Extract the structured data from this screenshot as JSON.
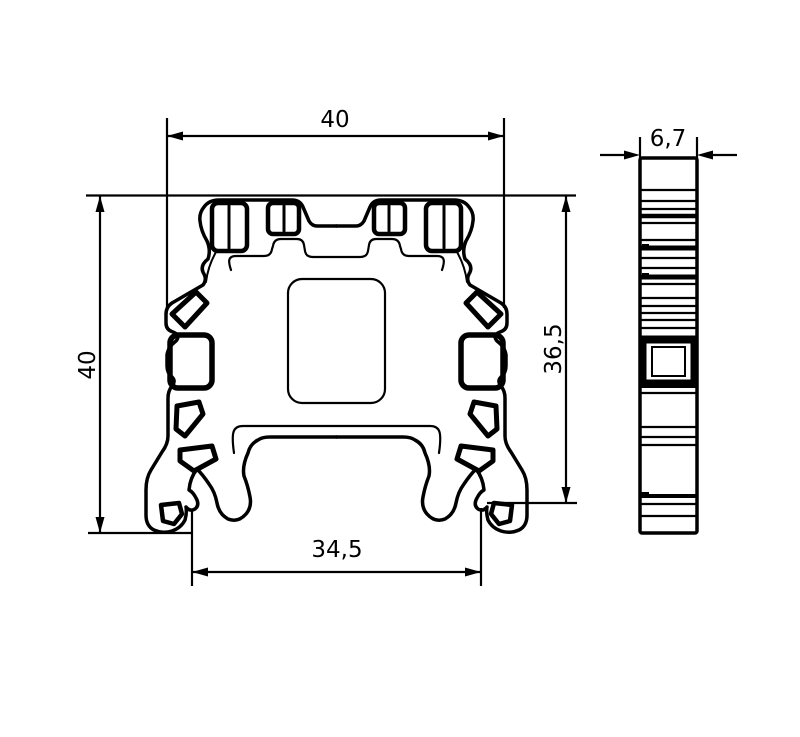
{
  "drawing": {
    "title": "terminal-block-profile-drawing",
    "background": "#ffffff",
    "line_color": "#000000",
    "views": [
      {
        "id": "front",
        "name": "front-section-view"
      },
      {
        "id": "side",
        "name": "side-profile-view"
      }
    ],
    "dimensions": {
      "width_top": {
        "label": "40",
        "orientation": "horizontal",
        "view": "front"
      },
      "height_left": {
        "label": "40",
        "orientation": "vertical",
        "view": "front"
      },
      "height_right": {
        "label": "36,5",
        "orientation": "vertical",
        "view": "front"
      },
      "width_bottom": {
        "label": "34,5",
        "orientation": "horizontal",
        "view": "front"
      },
      "depth_top": {
        "label": "6,7",
        "orientation": "horizontal",
        "view": "side"
      }
    }
  }
}
